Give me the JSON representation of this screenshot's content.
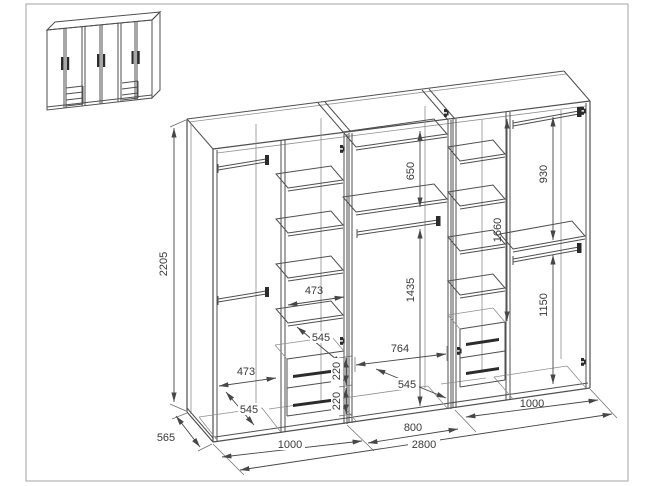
{
  "drawing": {
    "type": "wardrobe-assembly-dimension-drawing",
    "dimensions": {
      "height": "2205",
      "depth": "565",
      "width_left": "1000",
      "width_middle": "800",
      "width_right": "1000",
      "width_total": "2800",
      "left_shelf_width": "473",
      "left_shelf_depth": "545",
      "left_hang_width": "473",
      "left_hang_depth": "545",
      "left_drawer1_height": "220",
      "left_drawer2_height": "220",
      "middle_shelf_spacing": "650",
      "middle_hang_height": "1435",
      "middle_width": "764",
      "middle_depth": "545",
      "right_shelf_height": "1660",
      "right_top_hang": "930",
      "right_bottom_hang": "1150"
    }
  }
}
